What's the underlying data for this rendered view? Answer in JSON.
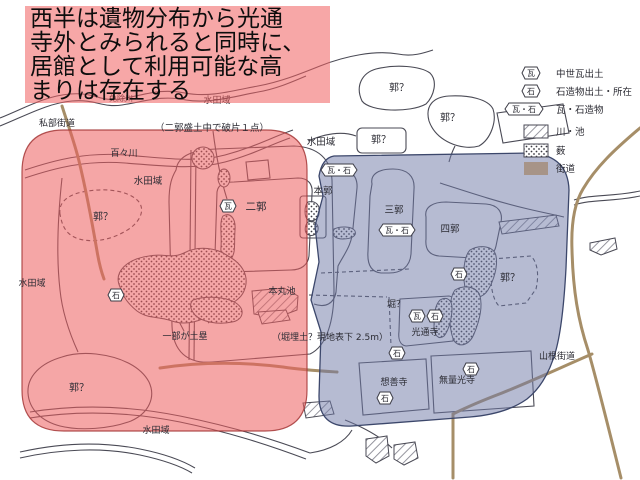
{
  "annotation": {
    "lines": [
      "西半は遺物分布から光通",
      "寺外とみられると同時に、",
      "居館として利用可能な高",
      "まりは存在する"
    ]
  },
  "legend": {
    "items": [
      {
        "badge": "瓦",
        "label": "中世瓦出土"
      },
      {
        "badge": "石",
        "label": "石造物出土・所在"
      },
      {
        "badge": "瓦・石",
        "label": "瓦・石造物"
      },
      {
        "label": "川・池"
      },
      {
        "label": "薮"
      },
      {
        "label": "街道"
      }
    ]
  },
  "map": {
    "badge_labels": {
      "kawara": "瓦",
      "ishi": "石",
      "kawara_ishi": "瓦・石"
    },
    "labels": {
      "kisabe_kaido": "私部街道",
      "menjo_river": "免除川",
      "suiden_top": "水田域",
      "nikaku_note": "（二郭盛土中で破片１点）",
      "dodo_river": "百々川",
      "suiden_left": "水田域",
      "kuruwa_left": "郭？",
      "nikaku": "二郭",
      "suiden_far_left": "水田域",
      "dorui": "一部が土塁",
      "kuruwa_bottom_left": "郭？",
      "suiden_bottom": "水田域",
      "suiden_center": "水田域",
      "kuruwa_box": "郭？",
      "kuruwa_top1": "郭？",
      "kuruwa_top2": "郭？",
      "honkaku": "本郭",
      "sankaku": "三郭",
      "shikaku": "四郭",
      "kuruwa_blue": "郭？",
      "hori": "堀？",
      "kotsuji": "光通寺",
      "hori_note": "（堀埋土？現地表下 2.5m）",
      "honmaru_ike": "本丸池",
      "sozenji": "想善寺",
      "muryokoji": "無量光寺",
      "yamane_kaido": "山根街道"
    },
    "colors": {
      "west_overlay": "#ee5c5c",
      "east_overlay": "#6e78a5",
      "road": "#a68e68",
      "line": "#4a4a55"
    }
  }
}
